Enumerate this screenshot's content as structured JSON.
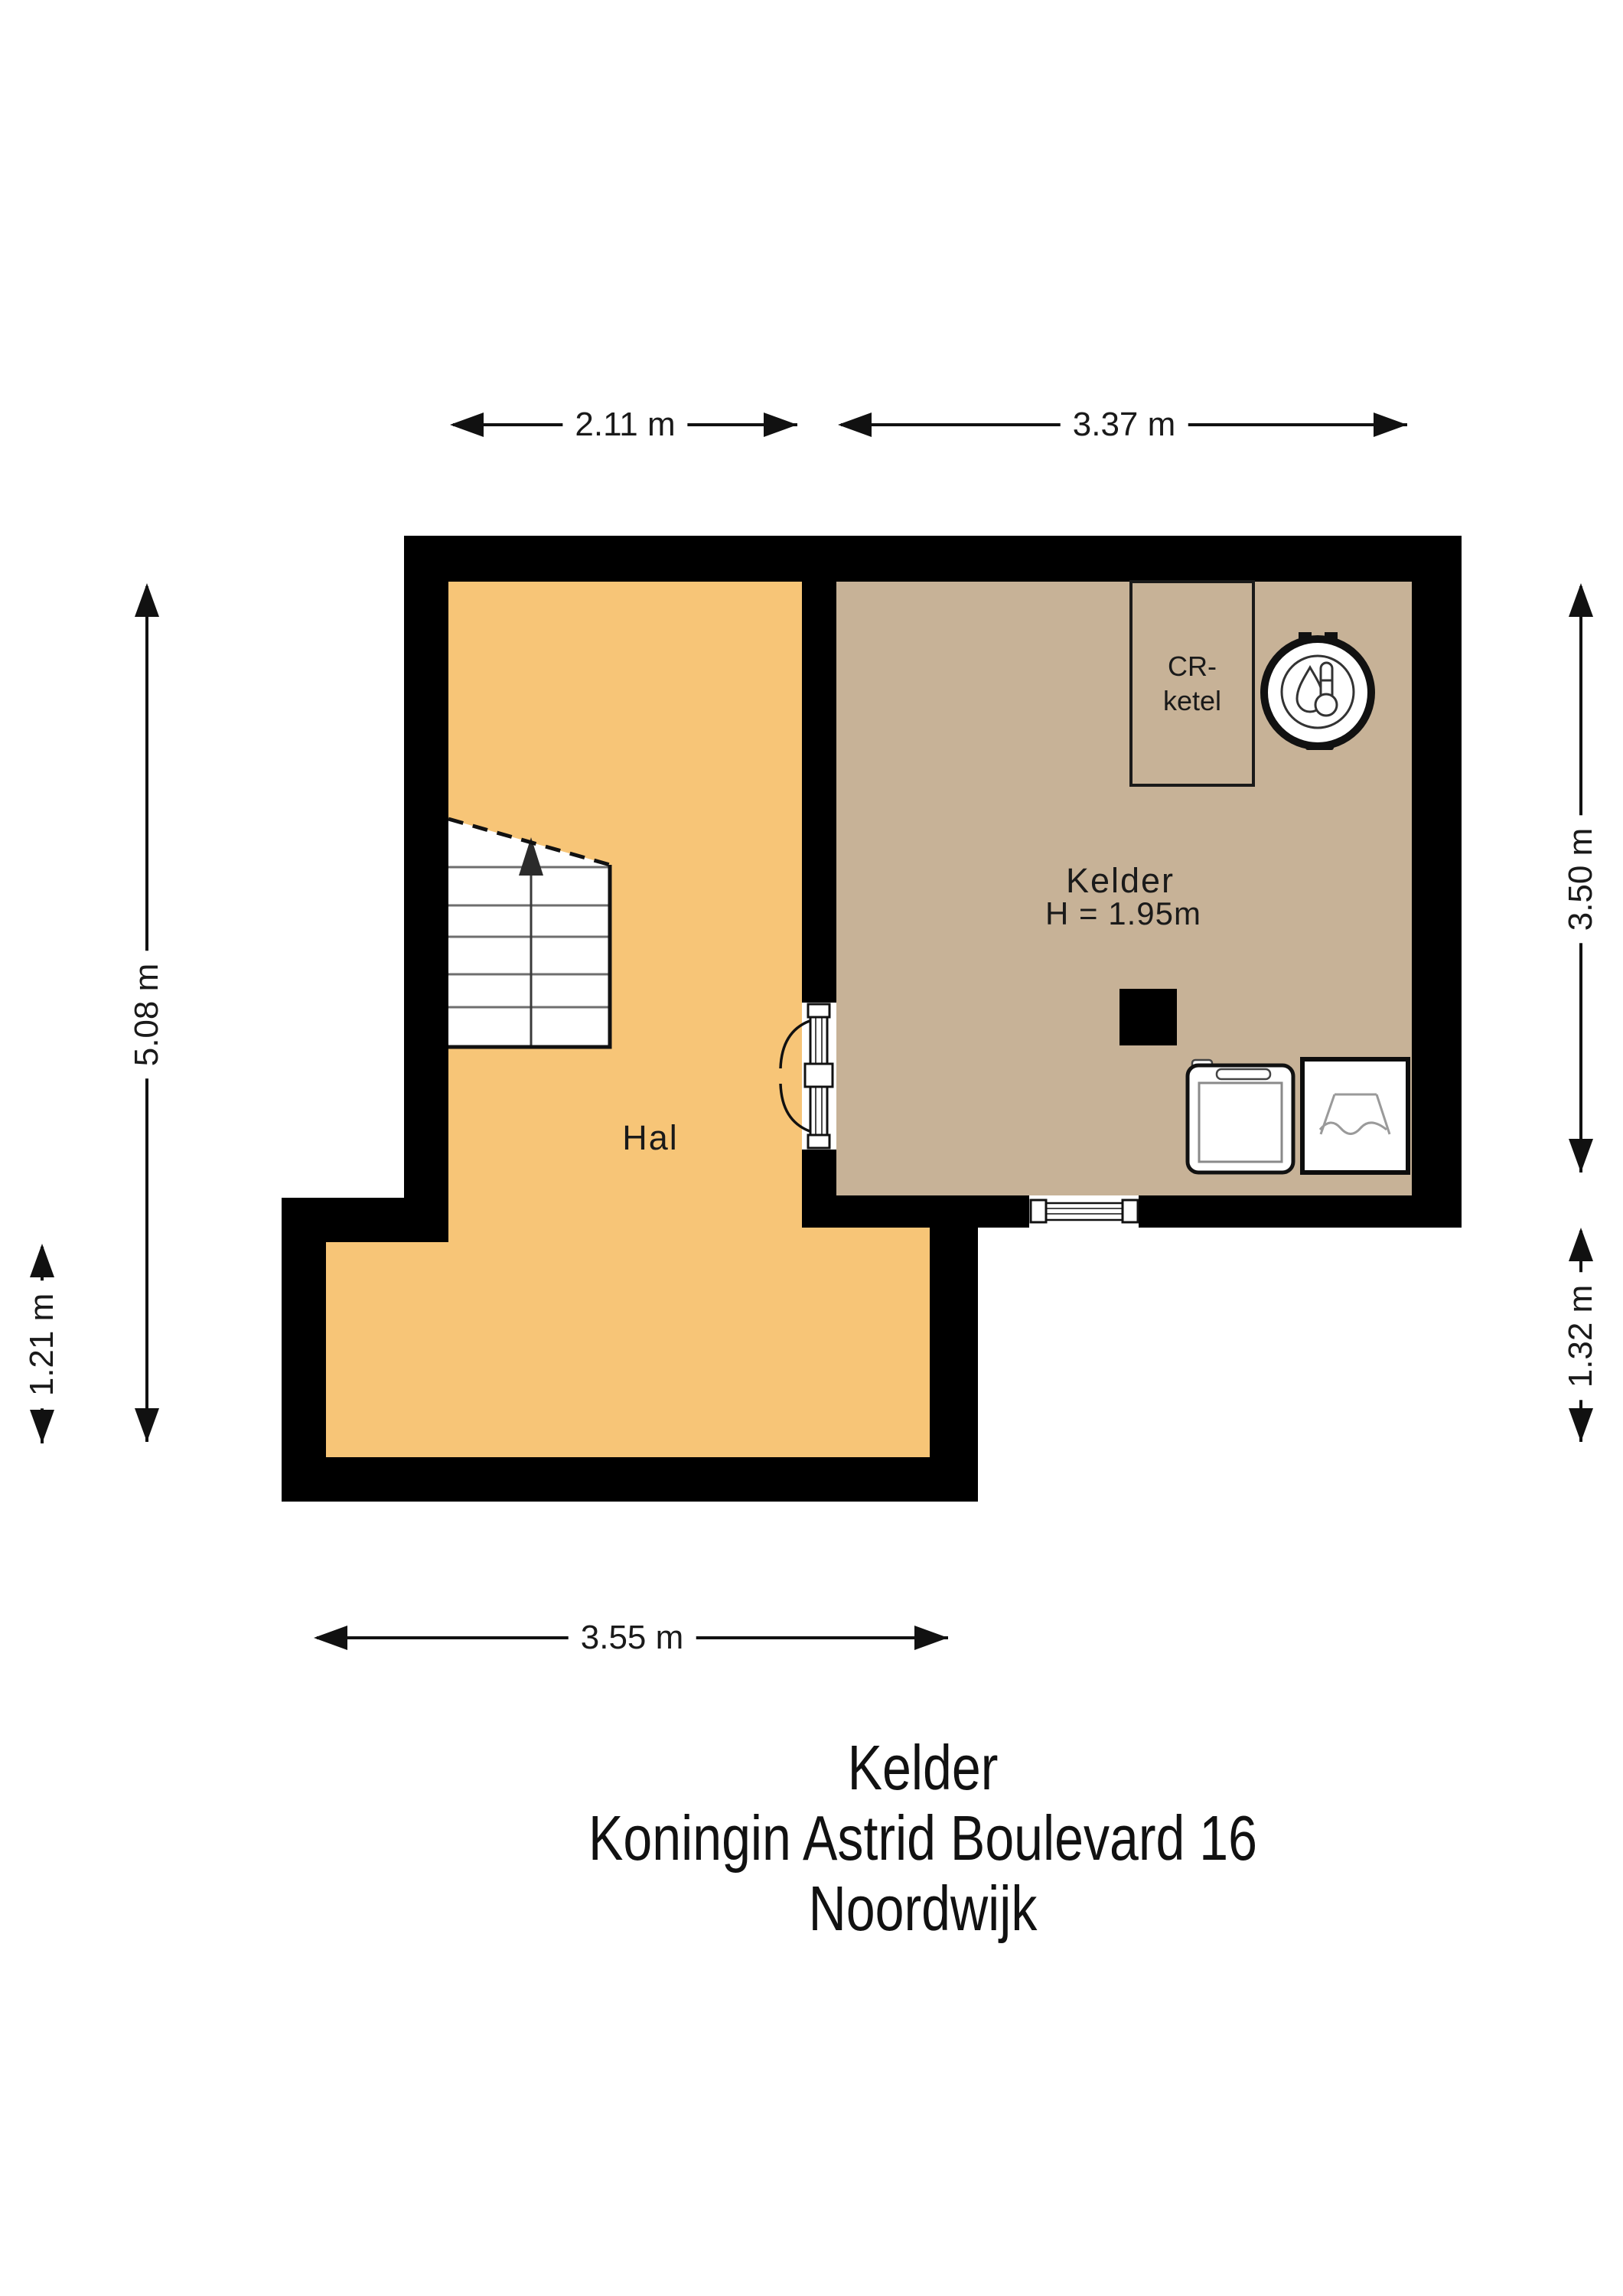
{
  "document": {
    "kind": "floor-plan"
  },
  "title": {
    "floor": "Kelder",
    "address": "Koningin Astrid Boulevard 16",
    "city": "Noordwijk"
  },
  "dimensions": {
    "top_left": "2.11 m",
    "top_right": "3.37 m",
    "left_outer": "5.08 m",
    "left_inner": "1.21 m",
    "right_upper": "3.50 m",
    "right_lower": "1.32 m",
    "bottom": "3.55 m"
  },
  "rooms": {
    "hal": {
      "label": "Hal",
      "floor_color": "#F7C577"
    },
    "kelder": {
      "label": "Kelder",
      "ceiling_height": "H = 1.95m",
      "floor_color": "#C7B297"
    }
  },
  "closet": {
    "label": "CR-\nketel"
  },
  "icons": {
    "boiler": "boiler-icon",
    "washer": "washing-machine-icon",
    "sink": "laundry-sink-icon",
    "stairs": "staircase-up-icon",
    "door": "double-swing-door-icon",
    "window": "window-icon",
    "column": "column-block"
  },
  "colors": {
    "wall": "#000000",
    "line": "#111111"
  }
}
